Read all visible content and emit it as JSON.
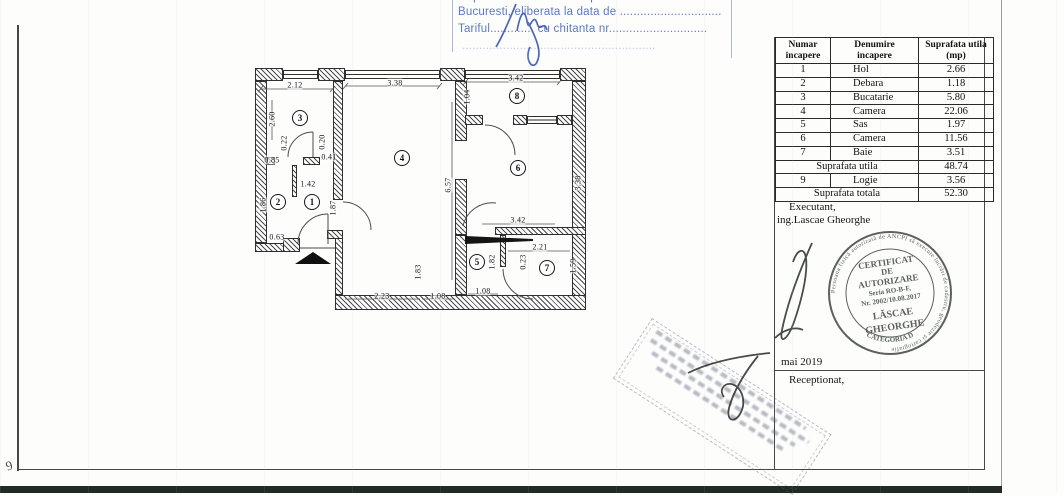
{
  "header_stamp": {
    "line1": "Copie conforma cu exemplarul din arhiva OCPI",
    "line2": "Bucuresti, eliberata la data de ..............................",
    "line3": "Tariful............. cu chitanta nr.............................",
    "line4": "........................................................."
  },
  "table": {
    "headers": [
      "Numar\nincapere",
      "Denumire\nincapere",
      "Suprafata utila\n(mp)"
    ],
    "rows": [
      [
        "1",
        "Hol",
        "2.66"
      ],
      [
        "2",
        "Debara",
        "1.18"
      ],
      [
        "3",
        "Bucatarie",
        "5.80"
      ],
      [
        "4",
        "Camera",
        "22.06"
      ],
      [
        "5",
        "Sas",
        "1.97"
      ],
      [
        "6",
        "Camera",
        "11.56"
      ],
      [
        "7",
        "Baie",
        "3.51"
      ]
    ],
    "subtotal_label": "Suprafata utila",
    "subtotal_value": "48.74",
    "extra_row": [
      "9",
      "Logie",
      "3.56"
    ],
    "total_label": "Suprafata totala",
    "total_value": "52.30"
  },
  "panel": {
    "executant_label": "Executant,",
    "executant_name": "ing.Lascae Gheorghe",
    "date": "mai 2019",
    "received_label": "Receptionat,"
  },
  "stamp": {
    "rim_text": "Persoana fizică autorizată de ANCPI să execute lucrări de cadastru, geodezie şi cartografie",
    "line1": "CERTIFICAT",
    "line2": "DE",
    "line3": "AUTORIZARE",
    "line4": "Seria RO-B-F,",
    "line5": "Nr. 2002/10.08.2017",
    "name1": "LĂSCAE",
    "name2": "GHEORGHE",
    "category": "CATEGORIA D"
  },
  "margin_mark": "9",
  "colors": {
    "stamp_blue": "#5b79c9",
    "ink": "#2a2a2a",
    "round_stamp_ink": "#454c47",
    "scan_band": "#212a24"
  },
  "plan": {
    "rooms": [
      {
        "n": "1",
        "x": 62,
        "y": 140
      },
      {
        "n": "2",
        "x": 28,
        "y": 140
      },
      {
        "n": "3",
        "x": 50,
        "y": 56
      },
      {
        "n": "4",
        "x": 152,
        "y": 96
      },
      {
        "n": "5",
        "x": 227,
        "y": 200
      },
      {
        "n": "6",
        "x": 268,
        "y": 106
      },
      {
        "n": "7",
        "x": 297,
        "y": 206
      },
      {
        "n": "8",
        "x": 267,
        "y": 34
      }
    ],
    "dims": [
      {
        "t": "2.12",
        "x": 45,
        "y": 23
      },
      {
        "t": "3.38",
        "x": 145,
        "y": 21
      },
      {
        "t": "3.42",
        "x": 266,
        "y": 16
      },
      {
        "t": "2.60",
        "x": 22,
        "y": 57,
        "v": true
      },
      {
        "t": "1.04",
        "x": 217,
        "y": 35,
        "v": true
      },
      {
        "t": "0.22",
        "x": 34,
        "y": 81,
        "v": true
      },
      {
        "t": "0.20",
        "x": 72,
        "y": 80,
        "v": true
      },
      {
        "t": "0.85",
        "x": 22,
        "y": 98
      },
      {
        "t": "0.41",
        "x": 79,
        "y": 95
      },
      {
        "t": "1.42",
        "x": 58,
        "y": 122
      },
      {
        "t": "1.87",
        "x": 83,
        "y": 146,
        "v": true
      },
      {
        "t": "1.86",
        "x": 13,
        "y": 143,
        "v": true
      },
      {
        "t": "0.63",
        "x": 27,
        "y": 175
      },
      {
        "t": "6.57",
        "x": 198,
        "y": 123,
        "v": true
      },
      {
        "t": "3.38",
        "x": 328,
        "y": 121,
        "v": true
      },
      {
        "t": "2.23",
        "x": 132,
        "y": 234
      },
      {
        "t": "1.83",
        "x": 168,
        "y": 210,
        "v": true
      },
      {
        "t": "1.08",
        "x": 188,
        "y": 234
      },
      {
        "t": "1.08",
        "x": 233,
        "y": 229
      },
      {
        "t": "1.82",
        "x": 242,
        "y": 200,
        "v": true
      },
      {
        "t": "3.42",
        "x": 268,
        "y": 158
      },
      {
        "t": "2.21",
        "x": 290,
        "y": 185
      },
      {
        "t": "0.23",
        "x": 273,
        "y": 200,
        "v": true
      },
      {
        "t": "1.59",
        "x": 323,
        "y": 204,
        "v": true
      }
    ]
  }
}
